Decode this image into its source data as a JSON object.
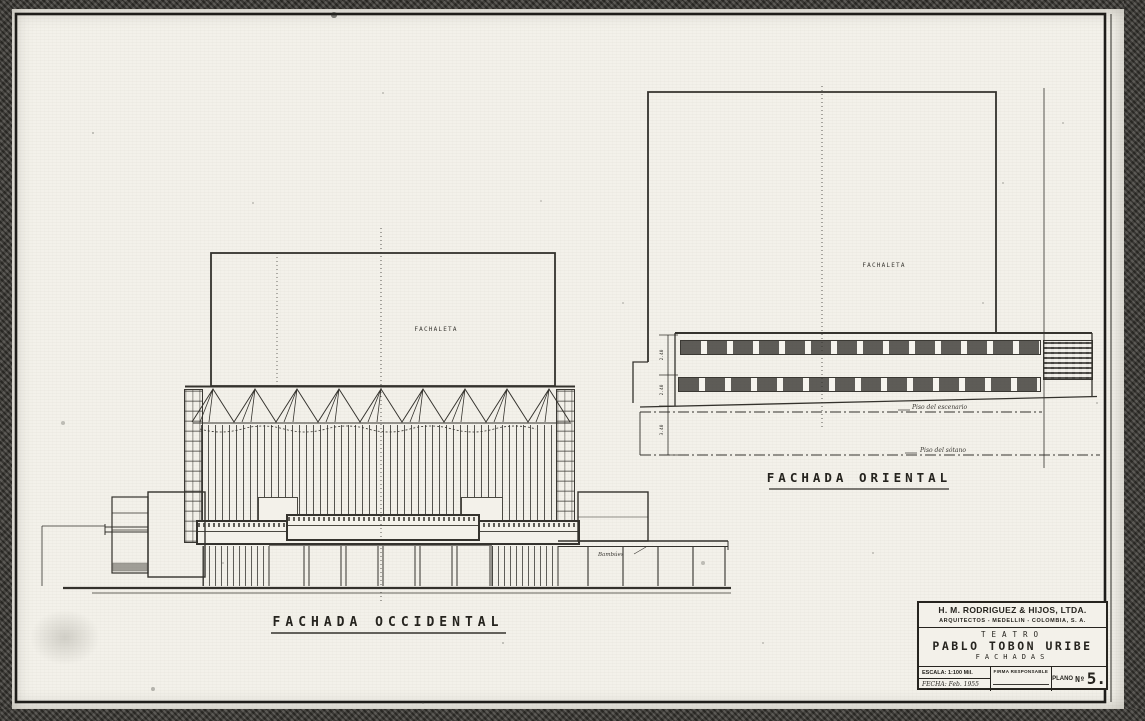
{
  "colors": {
    "paper": "#f3f1ea",
    "ink": "#34322d",
    "scan_edge": "#47453f"
  },
  "west_elevation": {
    "title": "FACHADA OCCIDENTAL",
    "wall_note": "FACHALETA",
    "canopy_note": "Bambúes"
  },
  "east_elevation": {
    "title": "FACHADA ORIENTAL",
    "wall_note": "FACHALETA",
    "stage_floor_label": "Piso del escenario",
    "basement_floor_label": "Piso del sótano",
    "dims": {
      "d1": "2.40",
      "d2": "2.40",
      "d3": "3.40"
    }
  },
  "title_block": {
    "firm": "H. M. RODRIGUEZ & HIJOS, LTDA.",
    "firm_info": "ARQUITECTOS  -  MEDELLIN  -  COLOMBIA, S. A.",
    "project_type": "TEATRO",
    "project_name": "PABLO TOBON URIBE",
    "sheet_subject": "FACHADAS",
    "scale": "ESCALA: 1:100 Mil.",
    "date": "FECHA: Feb. 1955",
    "signature": "FIRMA RESPONSABLE",
    "sheet_label": "PLANO",
    "sheet_ordinal": "Nº",
    "sheet_digit": "5."
  }
}
